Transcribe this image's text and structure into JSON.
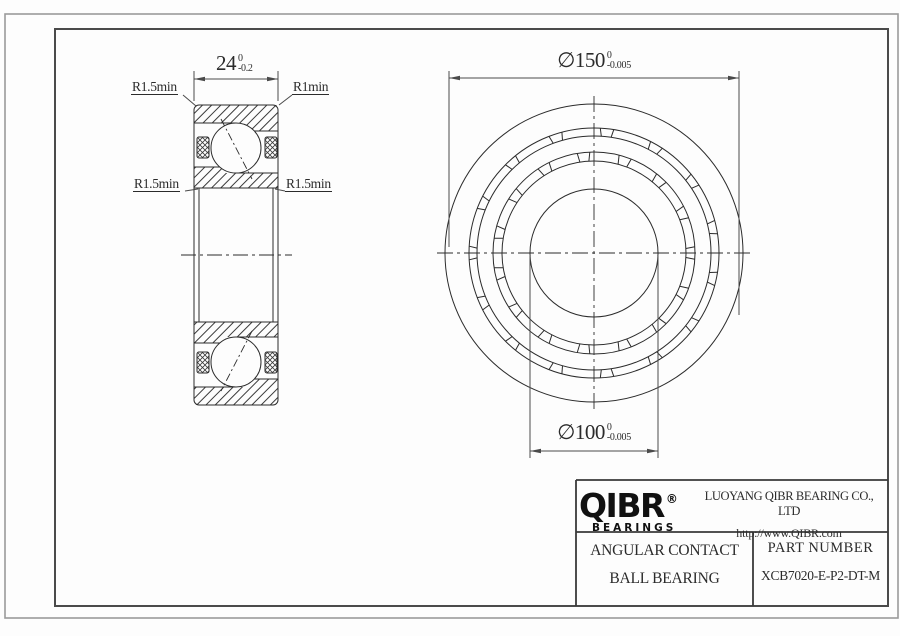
{
  "colors": {
    "line": "#2b2b2b",
    "thin_line": "#4a4a4a",
    "outer_border": "#9a9a9a",
    "inner_border": "#4a4a4a",
    "background": "#fdfdfd"
  },
  "section_view": {
    "width_dim": {
      "value": "24",
      "tol_upper": "0",
      "tol_lower": "-0.2"
    },
    "label_outer_left": "R1.5min",
    "label_outer_right": "R1min",
    "label_inner_left": "R1.5min",
    "label_inner_right": "R1.5min"
  },
  "front_view": {
    "od_dim": {
      "symbol": "∅",
      "value": "150",
      "tol_upper": "0",
      "tol_lower": "-0.005"
    },
    "bore_dim": {
      "symbol": "∅",
      "value": "100",
      "tol_upper": "0",
      "tol_lower": "-0.005"
    }
  },
  "title_block": {
    "logo_text": "QIBR",
    "logo_registered": "®",
    "logo_subtext": "BEARINGS",
    "company_name": "LUOYANG QIBR BEARING CO., LTD",
    "website": "http://www.QIBR.com",
    "product_type_line1": "ANGULAR CONTACT",
    "product_type_line2": "BALL BEARING",
    "part_number_label": "PART NUMBER",
    "part_number_value": "XCB7020-E-P2-DT-M"
  }
}
